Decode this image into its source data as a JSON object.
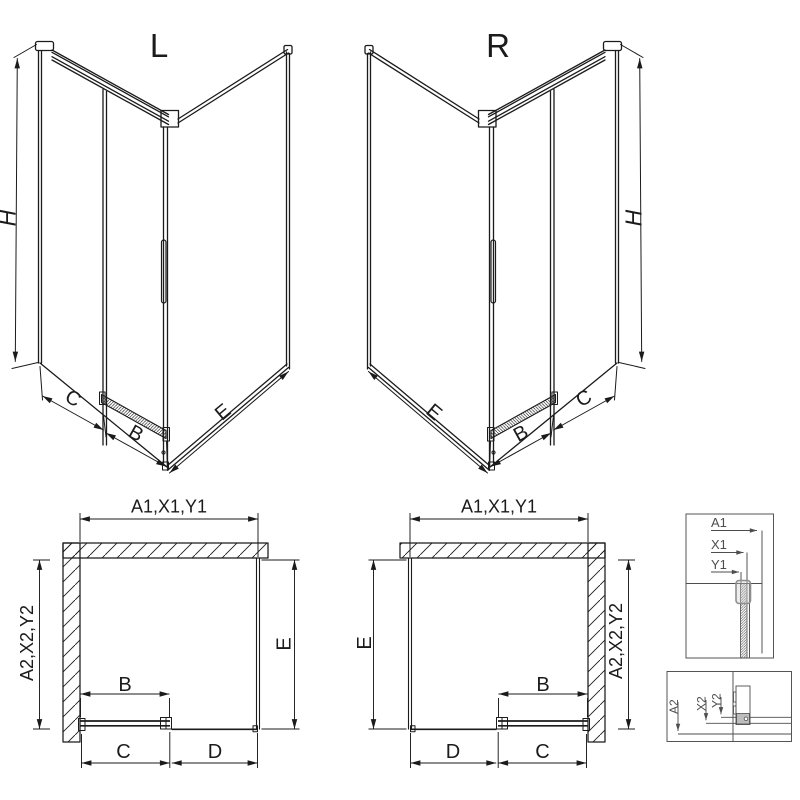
{
  "drawing": {
    "iso_left": {
      "title": "L",
      "height_dim": "H",
      "fixed_dim": "C",
      "door_dim": "B",
      "side_dim": "E"
    },
    "iso_right": {
      "title": "R",
      "height_dim": "H",
      "side_dim": "E",
      "door_dim": "B",
      "fixed_dim": "C"
    },
    "plan_left": {
      "width_dim": "A1,X1,Y1",
      "depth_dim": "A2,X2,Y2",
      "side_dim": "E",
      "door_dim": "B",
      "fixed_dim": "C",
      "opening_dim": "D"
    },
    "plan_right": {
      "width_dim": "A1,X1,Y1",
      "side_dim": "E",
      "depth_dim": "A2,X2,Y2",
      "door_dim": "B",
      "opening_dim": "D",
      "fixed_dim": "C"
    },
    "detail_wall_profile": {
      "dim_a": "A1",
      "dim_x": "X1",
      "dim_y": "Y1"
    },
    "detail_bottom_rail": {
      "dim_a": "A2",
      "dim_x": "X2",
      "dim_y": "Y2"
    }
  },
  "colors": {
    "line": "#1b1b1b",
    "detail_line": "#4d4d4d",
    "highlight_stroke": "#8f8f8f",
    "profile_fill": "#bdbdbd",
    "background": "#ffffff"
  }
}
